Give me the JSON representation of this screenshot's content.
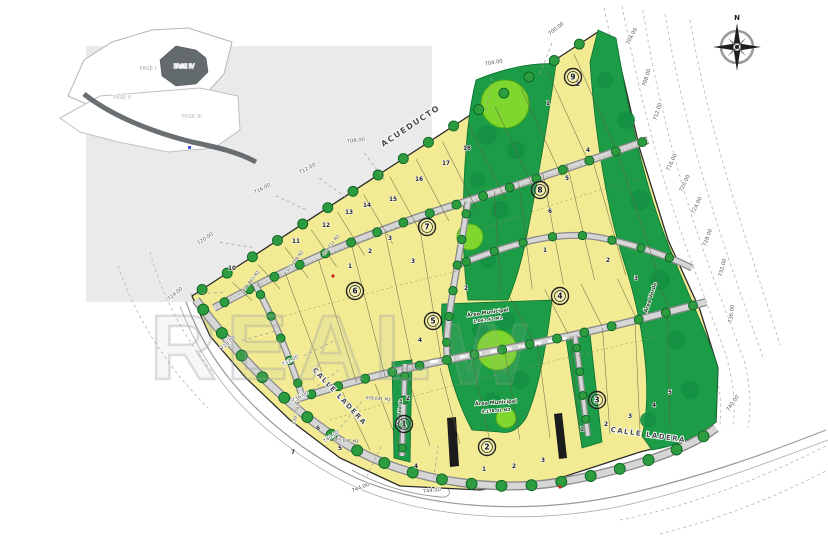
{
  "inset": {
    "items": [
      {
        "t": "FASE I",
        "x": 148,
        "y": 70,
        "c": "#a8acb0"
      },
      {
        "t": "FASE II",
        "x": 122,
        "y": 99,
        "c": "#b4b8bb"
      },
      {
        "t": "FASE III",
        "x": 192,
        "y": 118,
        "c": "#b4b8bb"
      },
      {
        "t": "FASE IV",
        "x": 184,
        "y": 68,
        "c": "#d3d7da"
      }
    ]
  },
  "compass": {
    "n": "N"
  },
  "watermark": {
    "left": "REAL",
    "mid": "W"
  },
  "street_labels": [
    {
      "t": "ACUEDUCTO",
      "x": 412,
      "y": 128,
      "r": -33.5,
      "s": 8
    },
    {
      "t": "CALLE LADERA",
      "x": 338,
      "y": 398,
      "r": 47,
      "s": 7
    },
    {
      "t": "CALLE LADERA",
      "x": 648,
      "y": 437,
      "r": 8,
      "s": 7
    }
  ],
  "contour_labels": [
    {
      "t": "700.00",
      "x": 557,
      "y": 30,
      "r": -38
    },
    {
      "t": "704.00",
      "x": 494,
      "y": 64,
      "r": -10
    },
    {
      "t": "704.00",
      "x": 633,
      "y": 37,
      "r": -62
    },
    {
      "t": "708.00",
      "x": 648,
      "y": 78,
      "r": -72
    },
    {
      "t": "712.00",
      "x": 659,
      "y": 112,
      "r": -72
    },
    {
      "t": "716.00",
      "x": 673,
      "y": 163,
      "r": -65
    },
    {
      "t": "720.00",
      "x": 686,
      "y": 184,
      "r": -65
    },
    {
      "t": "724.00",
      "x": 698,
      "y": 206,
      "r": -65
    },
    {
      "t": "728.00",
      "x": 709,
      "y": 238,
      "r": -70
    },
    {
      "t": "732.00",
      "x": 724,
      "y": 268,
      "r": -76
    },
    {
      "t": "736.00",
      "x": 733,
      "y": 314,
      "r": -82
    },
    {
      "t": "740.00",
      "x": 734,
      "y": 404,
      "r": -55
    },
    {
      "t": "708.00",
      "x": 356,
      "y": 142,
      "r": -6
    },
    {
      "t": "712.00",
      "x": 308,
      "y": 170,
      "r": -28
    },
    {
      "t": "716.00",
      "x": 263,
      "y": 190,
      "r": -28
    },
    {
      "t": "720.00",
      "x": 206,
      "y": 240,
      "r": -34
    },
    {
      "t": "724.00",
      "x": 176,
      "y": 295,
      "r": -40
    },
    {
      "t": "728.00",
      "x": 229,
      "y": 344,
      "r": -42
    },
    {
      "t": "732.00",
      "x": 291,
      "y": 362,
      "r": -30
    },
    {
      "t": "736.00",
      "x": 301,
      "y": 398,
      "r": -30
    },
    {
      "t": "740.00",
      "x": 332,
      "y": 438,
      "r": -34
    },
    {
      "t": "744.00",
      "x": 361,
      "y": 489,
      "r": -22
    },
    {
      "t": "744.00",
      "x": 432,
      "y": 492,
      "r": -6
    }
  ],
  "block_markers": [
    {
      "t": "9",
      "x": 573,
      "y": 77
    },
    {
      "t": "8",
      "x": 540,
      "y": 190
    },
    {
      "t": "7",
      "x": 427,
      "y": 227
    },
    {
      "t": "6",
      "x": 355,
      "y": 291
    },
    {
      "t": "5",
      "x": 433,
      "y": 321
    },
    {
      "t": "4",
      "x": 560,
      "y": 296
    },
    {
      "t": "3",
      "x": 597,
      "y": 400
    },
    {
      "t": "2",
      "x": 487,
      "y": 447
    },
    {
      "t": "1",
      "x": 404,
      "y": 424
    }
  ],
  "lot_numbers": [
    {
      "t": "10",
      "x": 232,
      "y": 270
    },
    {
      "t": "11",
      "x": 296,
      "y": 243
    },
    {
      "t": "12",
      "x": 326,
      "y": 227
    },
    {
      "t": "13",
      "x": 349,
      "y": 214
    },
    {
      "t": "14",
      "x": 367,
      "y": 207
    },
    {
      "t": "15",
      "x": 393,
      "y": 201
    },
    {
      "t": "16",
      "x": 419,
      "y": 181
    },
    {
      "t": "17",
      "x": 446,
      "y": 165
    },
    {
      "t": "18",
      "x": 467,
      "y": 150
    },
    {
      "t": "1",
      "x": 548,
      "y": 105
    },
    {
      "t": "2",
      "x": 578,
      "y": 86
    },
    {
      "t": "4",
      "x": 588,
      "y": 152
    },
    {
      "t": "5",
      "x": 567,
      "y": 180
    },
    {
      "t": "6",
      "x": 550,
      "y": 213
    },
    {
      "t": "1",
      "x": 350,
      "y": 268
    },
    {
      "t": "2",
      "x": 370,
      "y": 253
    },
    {
      "t": "3",
      "x": 390,
      "y": 240
    },
    {
      "t": "3",
      "x": 413,
      "y": 263
    },
    {
      "t": "2",
      "x": 466,
      "y": 290
    },
    {
      "t": "4",
      "x": 420,
      "y": 342
    },
    {
      "t": "1",
      "x": 545,
      "y": 252
    },
    {
      "t": "2",
      "x": 608,
      "y": 262
    },
    {
      "t": "3",
      "x": 636,
      "y": 280
    },
    {
      "t": "1",
      "x": 582,
      "y": 431
    },
    {
      "t": "2",
      "x": 606,
      "y": 426
    },
    {
      "t": "3",
      "x": 630,
      "y": 418
    },
    {
      "t": "4",
      "x": 654,
      "y": 407
    },
    {
      "t": "5",
      "x": 670,
      "y": 394
    },
    {
      "t": "1",
      "x": 484,
      "y": 471
    },
    {
      "t": "2",
      "x": 514,
      "y": 468
    },
    {
      "t": "3",
      "x": 543,
      "y": 462
    },
    {
      "t": "4",
      "x": 416,
      "y": 468
    },
    {
      "t": "2",
      "x": 408,
      "y": 400
    },
    {
      "t": "5",
      "x": 340,
      "y": 450
    },
    {
      "t": "6",
      "x": 318,
      "y": 430
    },
    {
      "t": "7",
      "x": 293,
      "y": 454
    }
  ],
  "area_labels": [
    {
      "t": "436.863 M2",
      "x": 252,
      "y": 282,
      "r": -52
    },
    {
      "t": "523.209 M2",
      "x": 296,
      "y": 262,
      "r": -52
    },
    {
      "t": "498.211 M2",
      "x": 332,
      "y": 246,
      "r": -52
    },
    {
      "t": "539.370 M2",
      "x": 298,
      "y": 412,
      "r": -78
    },
    {
      "t": "479.041 M2",
      "x": 378,
      "y": 400,
      "r": 4
    },
    {
      "t": "465.612 M2",
      "x": 346,
      "y": 442,
      "r": 4
    }
  ],
  "green_labels": [
    {
      "t": "Área Municipal",
      "x": 488,
      "y": 314,
      "r": -8,
      "s": 5
    },
    {
      "t": "1.047.42 M2",
      "x": 488,
      "y": 321,
      "r": -8,
      "s": 4.2
    },
    {
      "t": "Área Municipal",
      "x": 496,
      "y": 404,
      "r": -4,
      "s": 5
    },
    {
      "t": "4.178.01 M2",
      "x": 496,
      "y": 412,
      "r": -4,
      "s": 4.2
    },
    {
      "t": "Área Verde",
      "x": 652,
      "y": 298,
      "r": -72,
      "s": 5
    },
    {
      "t": "Área Verde",
      "x": 401,
      "y": 412,
      "r": -84,
      "s": 4.2
    }
  ],
  "colors": {
    "lot": "#f2eb93",
    "green": "#1d9c47",
    "green_light": "#7fd62e",
    "street": "#d6d6d6",
    "tree": "#2d9c3e",
    "boundary": "#2b2b2b"
  }
}
